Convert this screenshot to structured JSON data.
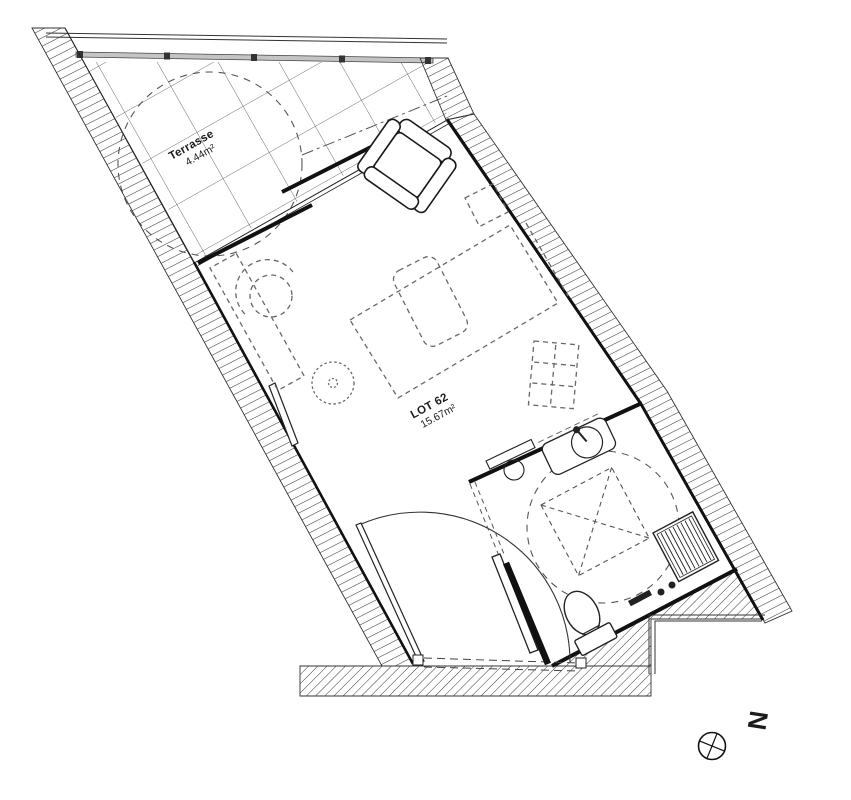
{
  "title": "Apartment floor plan",
  "labels": {
    "lot": {
      "name": "LOT 62",
      "area": "15.67m²"
    },
    "terrace": {
      "name": "Terrasse",
      "area": "4.44m²"
    },
    "north": "N"
  },
  "colors": {
    "background": "#ffffff",
    "line": "#1a1a1a",
    "hatch": "#3a3a3a",
    "furniture_dash": "#686868",
    "railing_fill": "#c4c4c4",
    "grid_line": "#4a4a4a"
  },
  "icons": {
    "north_arrow": "compass-crosshair-icon"
  },
  "furniture_semantics": [
    "armchair",
    "bed",
    "pillow",
    "nightstand",
    "sideboard-desk",
    "shell-chair",
    "side-table",
    "kitchenette-unit",
    "vanity-sink",
    "shower-bench",
    "toilet",
    "entrance-swing-door",
    "bathroom-sliding-door",
    "accessibility-turning-circle"
  ]
}
